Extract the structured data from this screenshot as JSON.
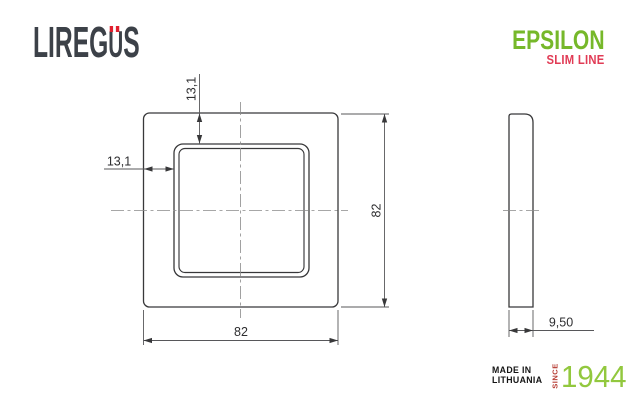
{
  "header": {
    "brand": {
      "text": "LIREGÜS",
      "prefix": "LIREG",
      "u_char": "U",
      "suffix": "S",
      "color": "#3c4148",
      "umlaut_color": "#e0202e"
    },
    "series": {
      "name": "EPSILON",
      "subtitle": "SLIM LINE",
      "name_color": "#76b82a",
      "subtitle_color": "#e13b55"
    }
  },
  "drawing": {
    "front_view": {
      "width_label": "82",
      "height_label": "82",
      "inset_top_label": "13,1",
      "inset_left_label": "13,1"
    },
    "side_view": {
      "thickness_label": "9,50"
    },
    "line_color": "#38383a",
    "dimension_color": "#2e2e30"
  },
  "footer": {
    "made_in_line1": "MADE IN",
    "made_in_line2": "LITHUANIA",
    "since": "SINCE",
    "year": "1944",
    "since_color": "#b63b32",
    "year_color": "#92c83e"
  }
}
